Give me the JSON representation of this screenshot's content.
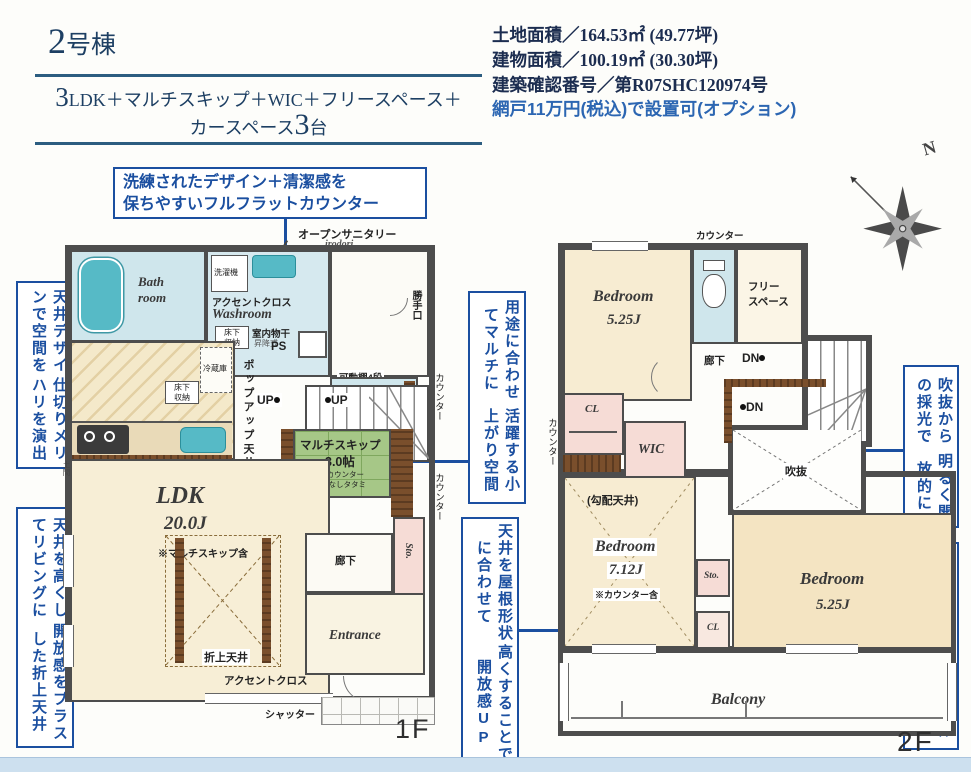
{
  "header": {
    "building_num": "2",
    "building_suffix": "号棟",
    "layout_num": "3",
    "layout_rest": "LDK＋マルチスキップ＋WIC＋フリースペース＋",
    "layout2_pre": "カースペース",
    "layout2_num": "3",
    "layout2_suf": "台",
    "land_area": "土地面積／164.53㎡ (49.77坪)",
    "building_area": "建物面積／100.19㎡ (30.30坪)",
    "confirm_no": "建築確認番号／第R07SHC120974号",
    "screen_note": "網戸11万円(税込)で設置可(オプション)"
  },
  "compass": {
    "north": "N"
  },
  "callouts": {
    "counter_l1": "洗練されたデザイン＋清潔感を",
    "counter_l2": "保ちやすいフルフラットカウンター",
    "left1_c1": "天井デザインで空間を",
    "left1_c2": "仕切りメリハリを演出",
    "left2_c1": "天井を高くしてリビングに",
    "left2_c2": "開放感をプラスした折上天井",
    "mid1_c1": "用途に合わせてマルチに",
    "mid1_c2": "活躍する小上がり空間",
    "mid2_c1": "天井を屋根形状に合わせて",
    "mid2_c2": "高くすることで開放感UP",
    "right1_c1": "吹抜からの採光で",
    "right1_c2": "明るく開放的に",
    "right2_c1": "2部屋から行き来できる",
    "right2_c2": "続きバルコニー"
  },
  "f1": {
    "floor_label": "1F",
    "open_sanitary": "オープンサニタリー",
    "irodori": "irodori",
    "bath1": "Bath",
    "bath2": "room",
    "washer": "洗濯機",
    "accent_top": "アクセントクロス",
    "washroom": "Washroom",
    "underfloor1a": "床下",
    "underfloor1b": "収納",
    "drying": "室内物干",
    "drying_sub": "昇降式",
    "backdoor": "勝手口",
    "shelf4": "可動棚4段",
    "ps": "PS",
    "popup": "ポップアップ天井",
    "counter_r1": "カウンター",
    "counter_r2": "カウンター",
    "up1": "UP",
    "up2": "UP",
    "fridge": "冷蔵庫",
    "underfloor2a": "床下",
    "underfloor2b": "収納",
    "shelf3": "可動棚3段",
    "doma": "土間",
    "multiskip1": "マルチスキップ",
    "multiskip2": "3.0帖",
    "multiskip_n1": "※カウンター",
    "multiskip_n2": "縁なしタタミ",
    "upper_void1": "上部",
    "upper_void2": "吹抜",
    "ldk": "LDK",
    "ldk_size": "20.0J",
    "ldk_note": "※マルチスキップ含",
    "oriage": "折上天井",
    "accent_bottom": "アクセントクロス",
    "shutter": "シャッター",
    "hall": "廊下",
    "sto": "Sto.",
    "entrance": "Entrance"
  },
  "f2": {
    "floor_label": "2F",
    "counter_top": "カウンター",
    "bed1": "Bedroom",
    "bed1_size": "5.25J",
    "free1": "フリー",
    "free2": "スペース",
    "hall": "廊下",
    "dn1": "DN",
    "dn2": "DN",
    "cl1": "CL",
    "wic": "WIC",
    "void": "吹抜",
    "counter_left": "カウンター",
    "sloped": "(勾配天井)",
    "bed2": "Bedroom",
    "bed2_size": "7.12J",
    "bed2_note": "※カウンター含",
    "sto": "Sto.",
    "cl2": "CL",
    "bed3": "Bedroom",
    "bed3_size": "5.25J",
    "balcony": "Balcony"
  }
}
